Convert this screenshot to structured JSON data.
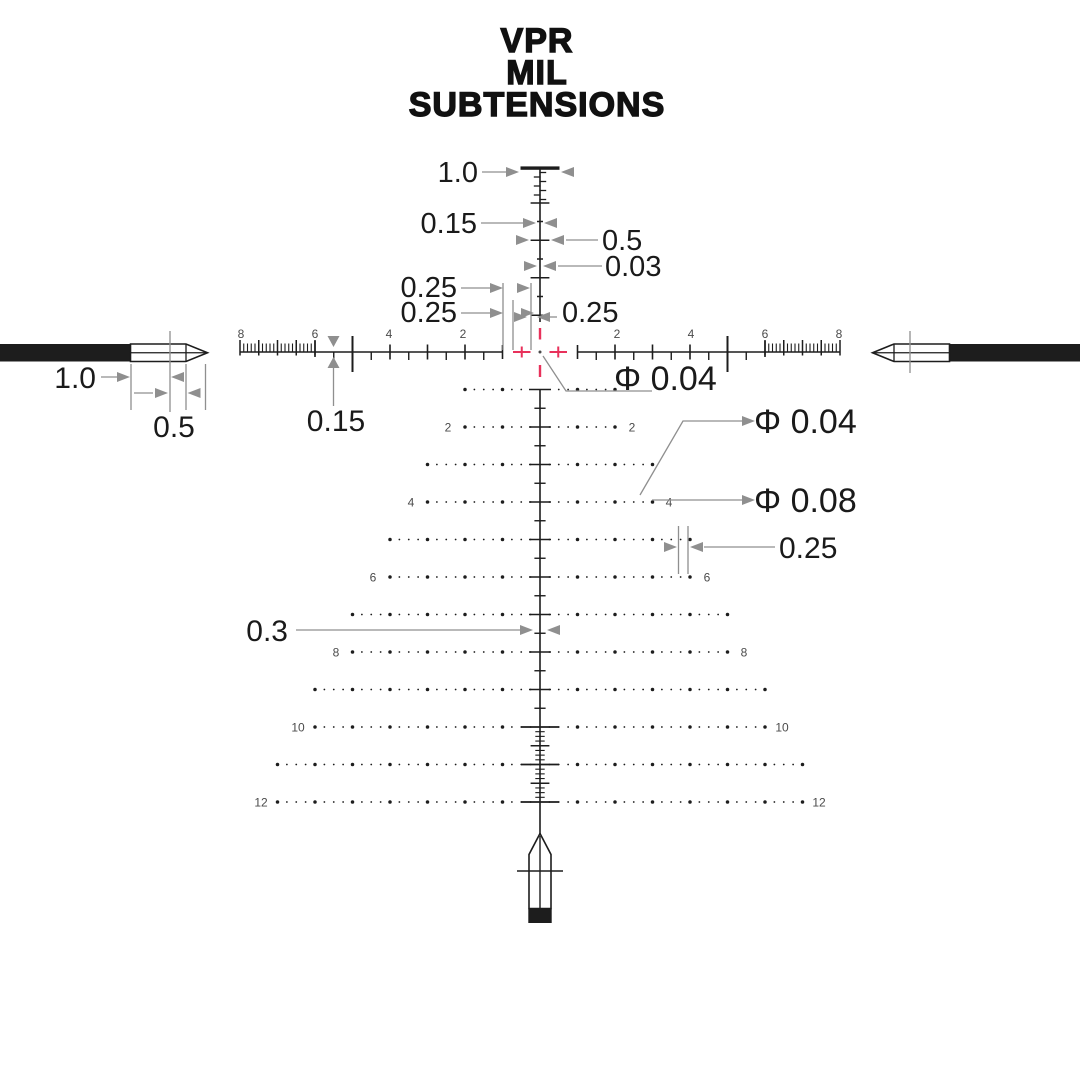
{
  "title": {
    "line1": "VPR",
    "line2": "MIL",
    "line3": "SUBTENSIONS"
  },
  "colors": {
    "reticle": "#1d1d1d",
    "annotation": "#8f8f8f",
    "accent_red": "#e8315b",
    "label": "#1a1a1a",
    "tick_number": "#4b4b4b",
    "background": "#ffffff"
  },
  "annotations": {
    "top_bar_width": "1.0",
    "upper_minor_tick_width": "0.15",
    "upper_major_tick_width": "0.5",
    "upper_post_line_width": "0.03",
    "quarter_left_1": "0.25",
    "quarter_left_2": "0.25",
    "quarter_right": "0.25",
    "center_dot_diameter": "Φ 0.04",
    "small_dot_diameter": "Φ 0.04",
    "large_dot_diameter": "Φ 0.08",
    "dot_spacing": "0.25",
    "lower_half_tick_width": "0.3",
    "main_line_thickness": "0.15",
    "post_tip_length": "1.0",
    "post_tip_half": "0.5"
  },
  "h_scale": {
    "left_numbers": [
      "8",
      "6",
      "4",
      "2"
    ],
    "right_numbers": [
      "2",
      "4",
      "6",
      "8"
    ]
  },
  "tree": {
    "row_numbers": [
      "2",
      "4",
      "6",
      "8",
      "10",
      "12"
    ]
  }
}
